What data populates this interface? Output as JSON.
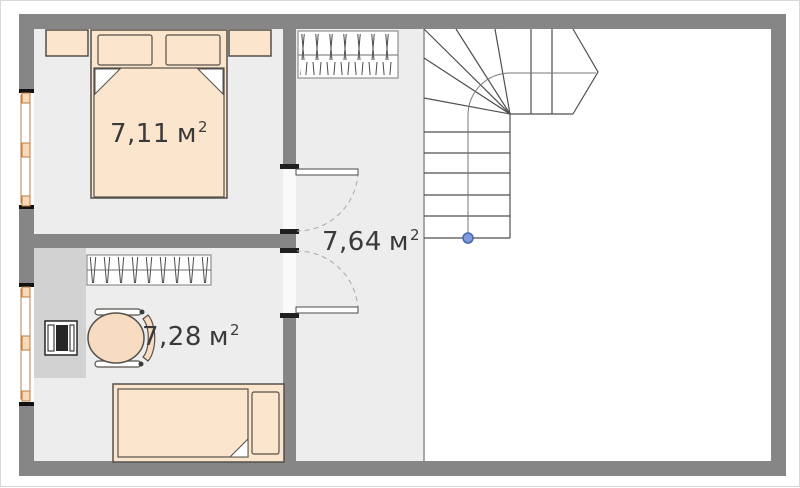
{
  "plan_type": "floor-plan",
  "rooms": [
    {
      "id": "bedroom-top",
      "area_value": "7,11",
      "area_unit": "м",
      "area_sup": "2"
    },
    {
      "id": "hallway",
      "area_value": "7,64",
      "area_unit": "м",
      "area_sup": "2"
    },
    {
      "id": "bedroom-bottom",
      "area_value": "7,28",
      "area_unit": "м",
      "area_sup": "2"
    }
  ],
  "icons": [
    "double-bed-icon",
    "pillow-icon",
    "nightstand-icon",
    "wardrobe-icon",
    "single-bed-icon",
    "desk-icon",
    "laptop-icon",
    "office-chair-icon",
    "staircase-icon",
    "door-swing-icon",
    "window-icon",
    "walkline-dot-icon"
  ],
  "colors": {
    "wall": "#868686",
    "floor": "#ededed",
    "stair_area_floor": "#ffffff",
    "furniture_fill": "#fbe5cd",
    "furniture_outline": "#55504a",
    "desk_fill": "#d2d2d2",
    "window_frame": "#c08148",
    "window_pane": "#f9d9b8",
    "stair_line": "#4f4f4f",
    "walkline_dot_fill": "#7e9ad8",
    "walkline_dot_stroke": "#4465b2",
    "door_jamb": "#1f1f1f",
    "label_text": "#3a3a3a"
  }
}
